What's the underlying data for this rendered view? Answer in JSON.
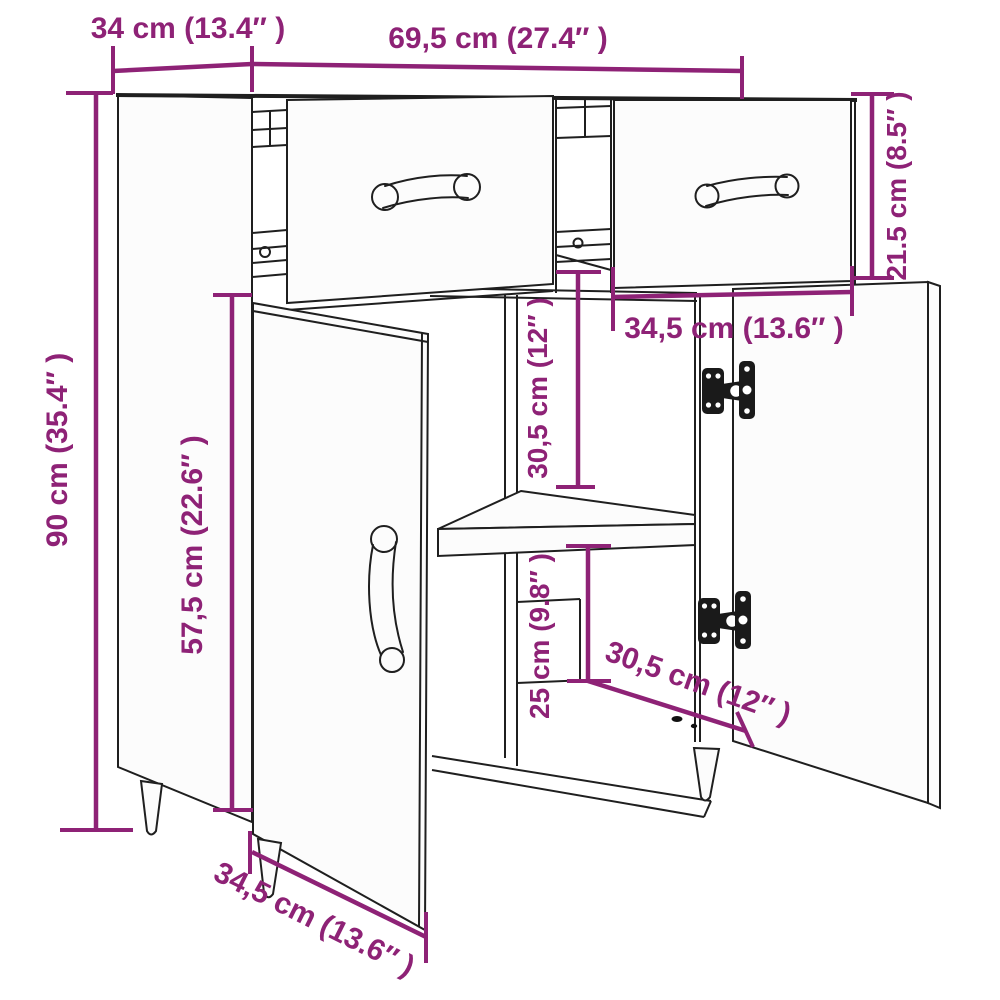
{
  "title": "Sideboard dimension line drawing",
  "colors": {
    "dimension_accent": "#8e2276",
    "line_art": "#1f1f1f",
    "background": "#ffffff",
    "panel_fill": "#fcfcfc"
  },
  "dims": {
    "top_depth": "34 cm (13.4″ )",
    "top_width": "69,5 cm (27.4″ )",
    "right_drawer_height": "21.5 cm (8.5″ )",
    "left_height": "90 cm (35.4″ )",
    "left_door_height": "57,5 cm (22.6″ )",
    "upper_compartment_height": "30,5 cm (12″ )",
    "drawer_width": "34,5 cm (13.6″ )",
    "lower_compartment_height": "25 cm (9.8″ )",
    "lower_compartment_depth": "30,5 cm (12″ )",
    "door_width": "34,5 cm (13.6″ )"
  }
}
